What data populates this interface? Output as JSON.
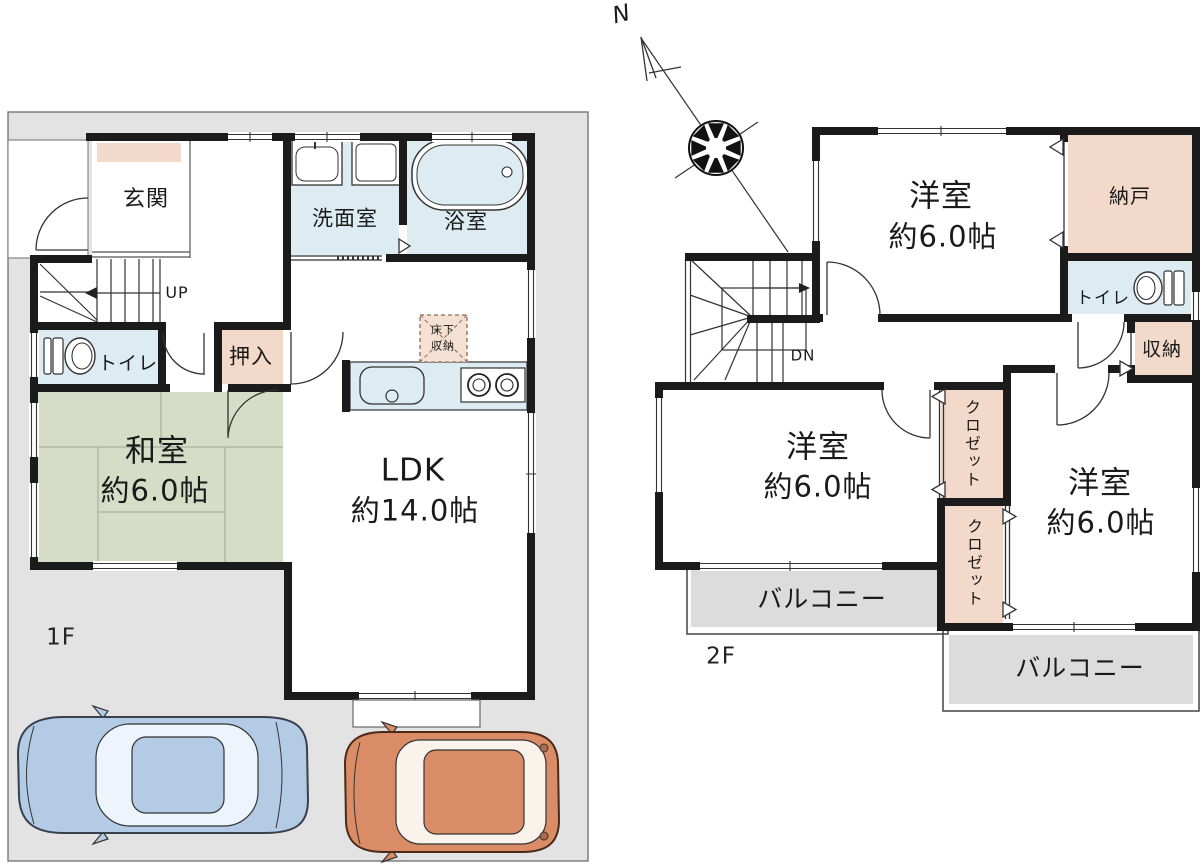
{
  "compass": {
    "north_label": "N"
  },
  "floor1": {
    "floor_label": "1F",
    "genkan": "玄関",
    "senmenshitsu": "洗面室",
    "yokushitsu": "浴室",
    "stairs_up": "UP",
    "toilet": "トイレ",
    "oshiire": "押入",
    "washitsu_name": "和室",
    "washitsu_size": "約6.0帖",
    "ldk_name": "LDK",
    "ldk_size": "約14.0帖",
    "yukashita_line1": "床下",
    "yukashita_line2": "収納"
  },
  "floor2": {
    "floor_label": "2F",
    "bedroom_top_name": "洋室",
    "bedroom_top_size": "約6.0帖",
    "nando": "納戸",
    "toilet": "トイレ",
    "stairs_down": "DN",
    "shuno": "収納",
    "bedroom_mid_name": "洋室",
    "bedroom_mid_size": "約6.0帖",
    "closet_top": "クロゼット",
    "closet_bottom": "クロゼット",
    "bedroom_right_name": "洋室",
    "bedroom_right_size": "約6.0帖",
    "balcony_left": "バルコニー",
    "balcony_right": "バルコニー"
  },
  "colors": {
    "wall": "#1b1b1b",
    "site_gray": "#e3e3e3",
    "wet_area_blue": "#ddecf2",
    "storage_pink": "#f3d9ca",
    "tatami_green": "#d5ddc7",
    "balcony_gray": "#dcdcdc",
    "car_blue": "#b4cbe5",
    "car_orange": "#d98c66"
  }
}
